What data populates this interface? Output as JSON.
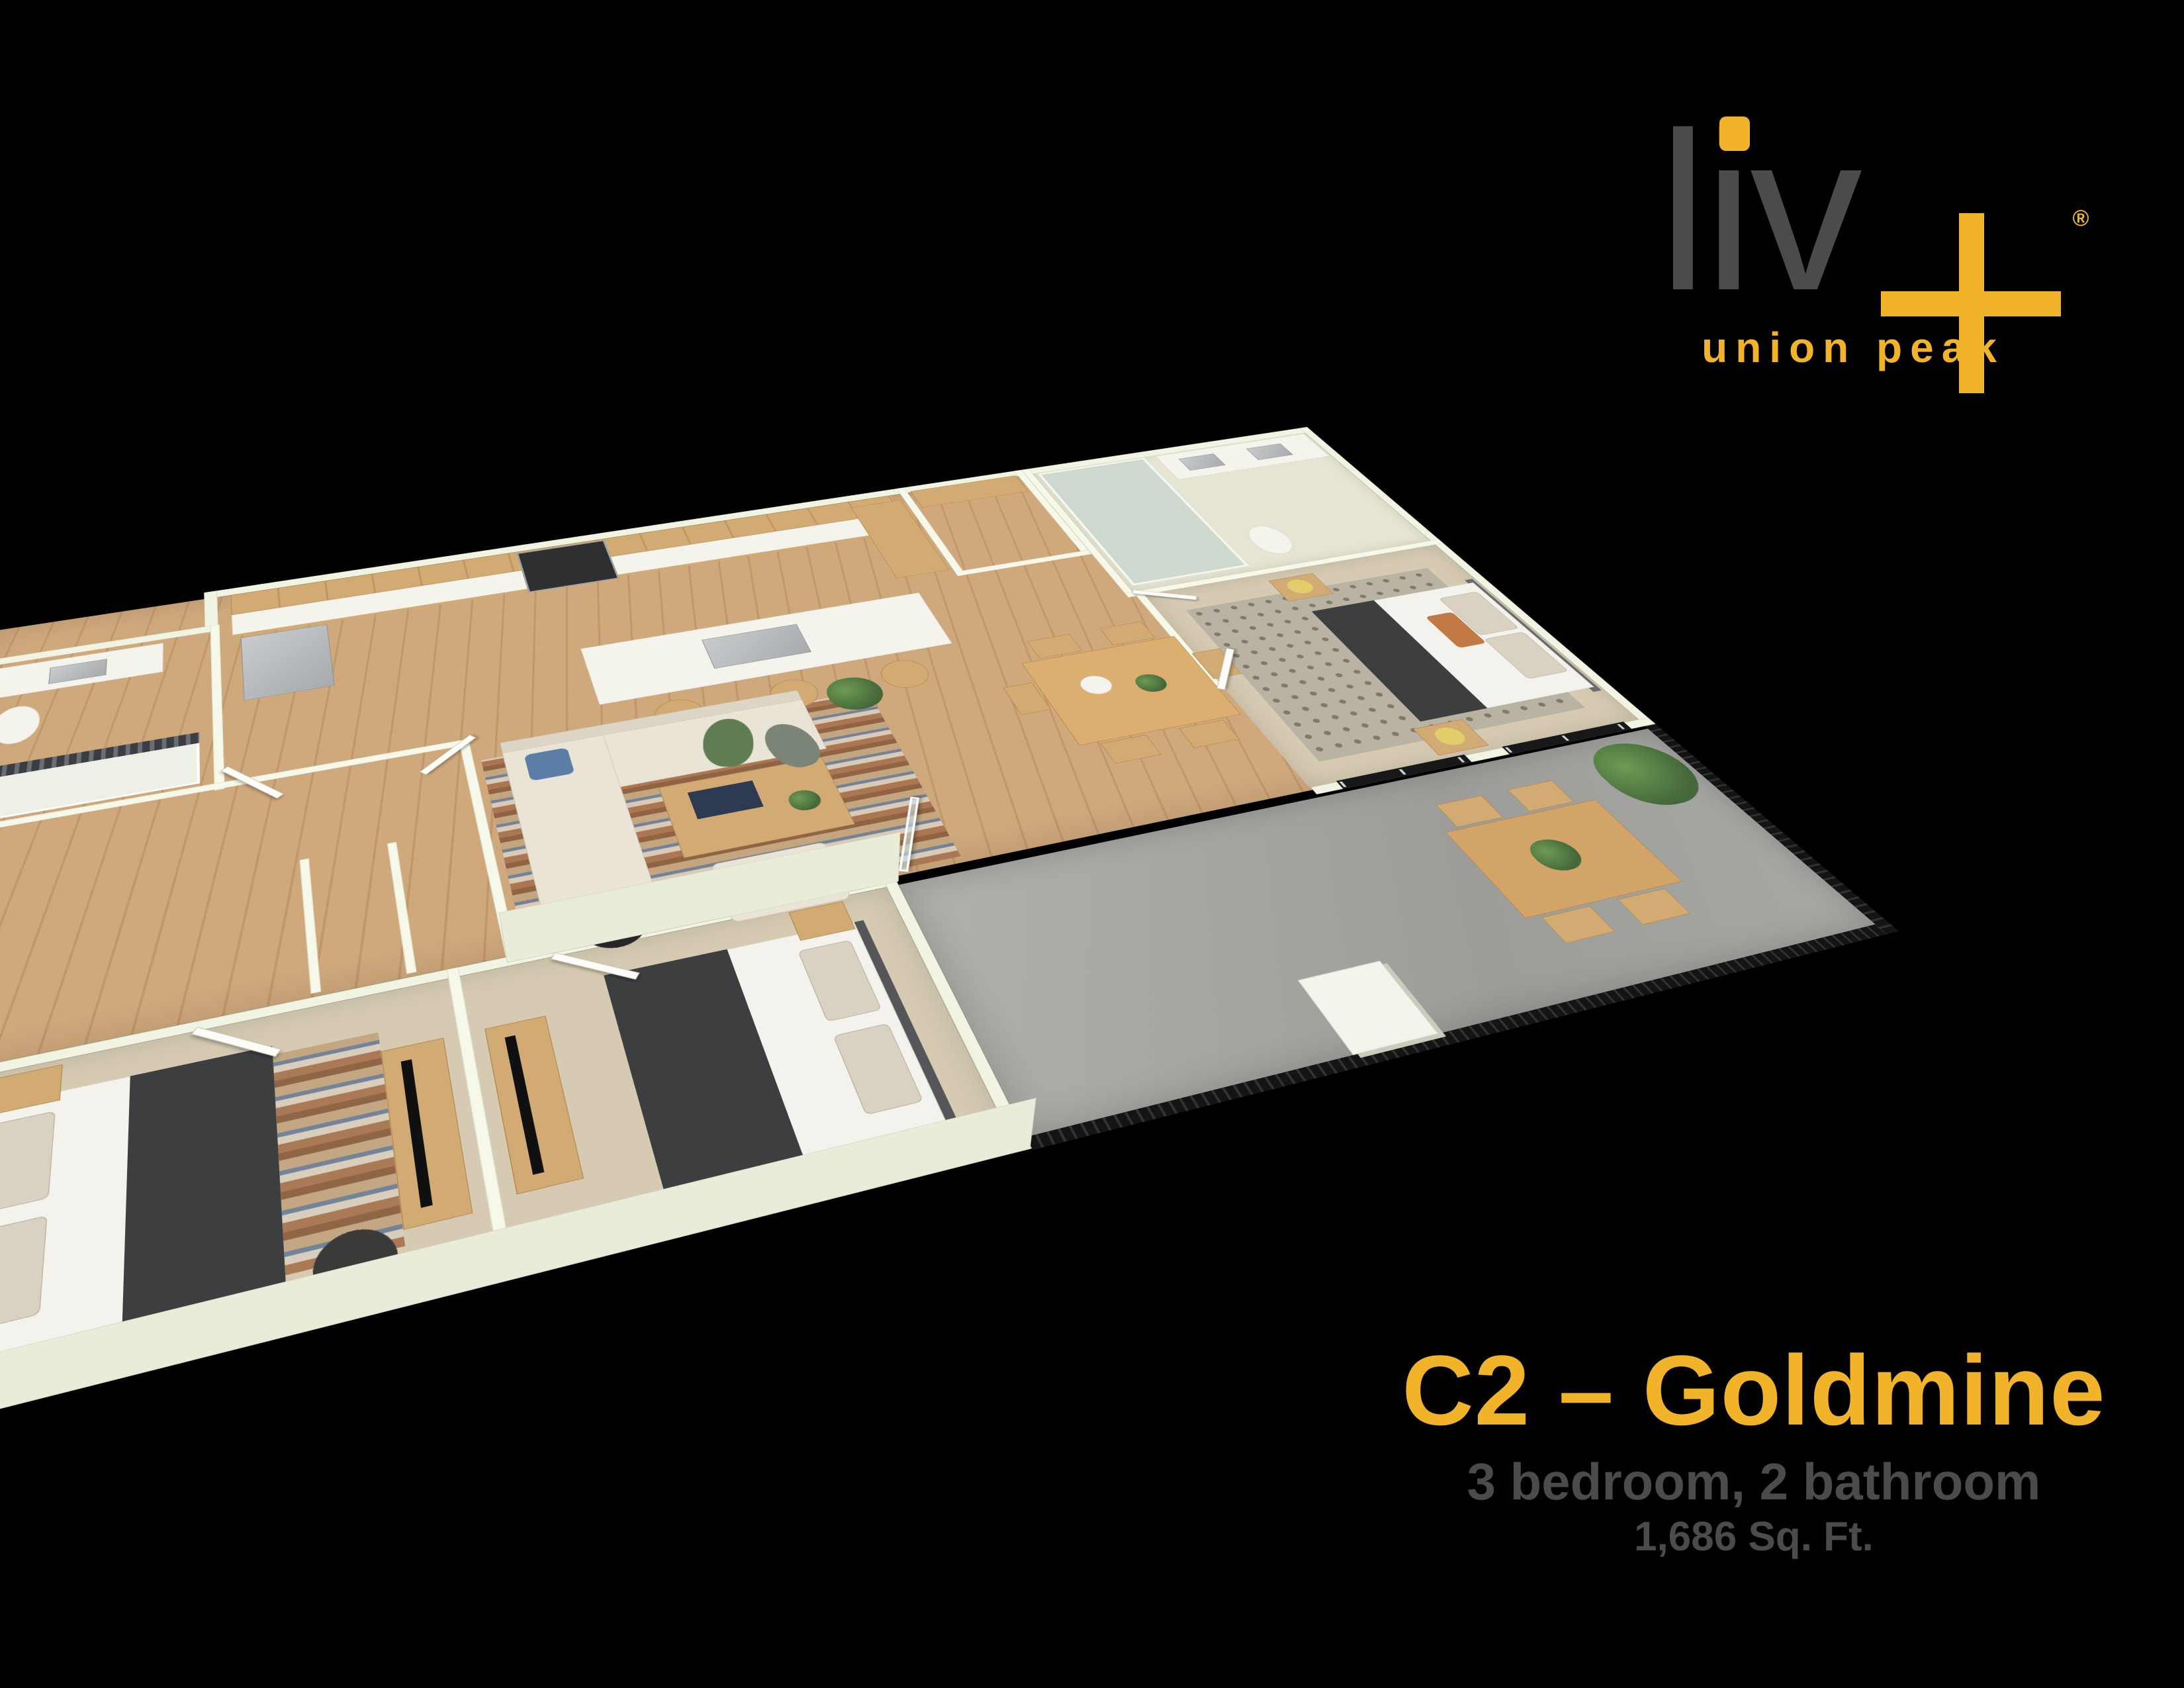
{
  "background_color": "#000000",
  "brand": {
    "logo_text": "liv",
    "registered_mark": "®",
    "tagline": "union peak",
    "colors": {
      "logo_gray": "#4a4b4d",
      "accent_yellow": "#f0b32a"
    }
  },
  "plan_info": {
    "name": "C2 – Goldmine",
    "bed_bath": "3 bedroom, 2 bathroom",
    "area": "1,686 Sq. Ft."
  },
  "floor_plan": {
    "style": "3D isometric rendering of apartment unit",
    "rooms": [
      "kitchen",
      "living room",
      "dining area",
      "master bedroom",
      "master bathroom",
      "hall bathroom",
      "bedroom 2",
      "bedroom 3",
      "walk-in closet",
      "patio"
    ],
    "palette": {
      "walls": "#f1f3e3",
      "wood_floor": "#caa376",
      "carpet": "#d6cab2",
      "patio_concrete": "#a8a8a4",
      "railing_black": "#1a1a1a",
      "cabinet_wood": "#d2ab74",
      "sofa_cream": "#eae4d6",
      "bedding_charcoal": "#3d3e40"
    }
  }
}
